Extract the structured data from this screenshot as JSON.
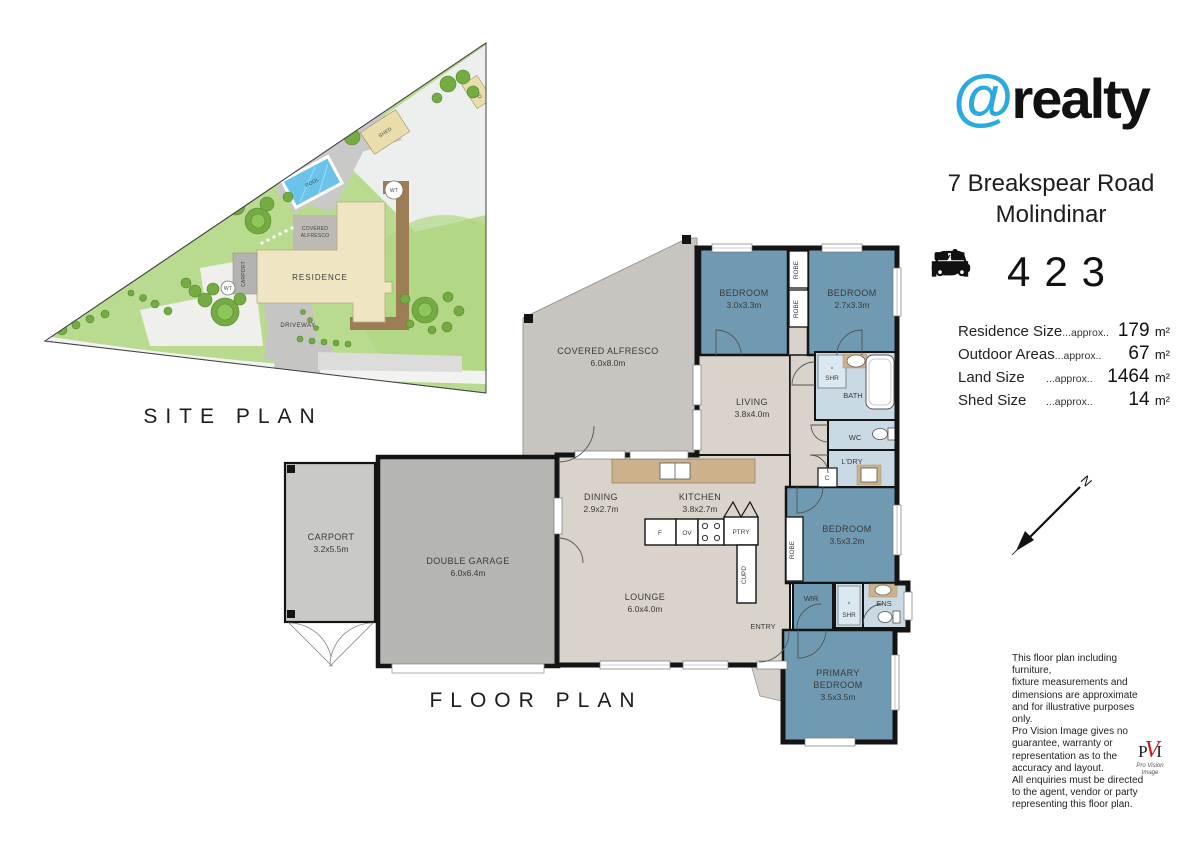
{
  "colors": {
    "brand_blue": "#29aae1",
    "bedroom_fill": "#6f9ab1",
    "wet_area_fill": "#c9dae4",
    "interior_fill": "#d9d3cc",
    "garage_fill": "#b5b6b2",
    "carport_fill": "#c9cac6",
    "alfresco_fill": "#c8c5c1",
    "bench_tan": "#cbb28c",
    "grass_green": "#b9db90",
    "pool_blue": "#6ac4ea",
    "residence_cream": "#efe5c3",
    "deck_brown": "#9d7d55",
    "pvi_red": "#c22026"
  },
  "site_plan": {
    "title": "SITE PLAN",
    "residence": "RESIDENCE",
    "pool": "POOL",
    "shed1": "SHED",
    "shed2": "SHED",
    "driveway": "DRIVEWAY",
    "carport": "CARPORT",
    "alfresco_line1": "COVERED",
    "alfresco_line2": "ALFRESCO",
    "wt1": "WT",
    "wt2": "WT"
  },
  "floor_plan": {
    "title": "FLOOR PLAN",
    "north": "N",
    "rooms": {
      "bedroom1": {
        "name": "BEDROOM",
        "dims": "3.0x3.3m"
      },
      "bedroom2": {
        "name": "BEDROOM",
        "dims": "2.7x3.3m"
      },
      "bedroom3": {
        "name": "BEDROOM",
        "dims": "3.5x3.2m"
      },
      "primary": {
        "name1": "PRIMARY",
        "name2": "BEDROOM",
        "dims": "3.5x3.5m"
      },
      "living": {
        "name": "LIVING",
        "dims": "3.8x4.0m"
      },
      "dining": {
        "name": "DINING",
        "dims": "2.9x2.7m"
      },
      "kitchen": {
        "name": "KITCHEN",
        "dims": "3.8x2.7m"
      },
      "lounge": {
        "name": "LOUNGE",
        "dims": "6.0x4.0m"
      },
      "alfresco": {
        "name": "COVERED ALFRESCO",
        "dims": "6.0x8.0m"
      },
      "garage": {
        "name": "DOUBLE GARAGE",
        "dims": "6.0x6.4m"
      },
      "carport": {
        "name": "CARPORT",
        "dims": "3.2x5.5m"
      }
    },
    "small": {
      "bath": "BATH",
      "shr_main": "SHR",
      "shr_ens": "SHR",
      "wc": "WC",
      "ldry": "L'DRY",
      "cupboard": "C",
      "robe1": "ROBE",
      "robe2": "ROBE",
      "robe3": "ROBE",
      "wir": "WIR",
      "ens": "ENS",
      "entry": "ENTRY",
      "ptry": "PTRY",
      "cupd": "CUPD",
      "fridge": "F",
      "oven": "OV"
    }
  },
  "panel": {
    "brand": {
      "at": "@",
      "name": "realty"
    },
    "address_line1": "7 Breakspear Road",
    "address_line2": "Molindinar",
    "features": {
      "beds": "4",
      "baths": "2",
      "cars": "3"
    },
    "sizes": [
      {
        "label": "Residence Size",
        "approx": "...approx..",
        "value": "179",
        "unit": "m²"
      },
      {
        "label": "Outdoor Areas",
        "approx": "...approx..",
        "value": "67",
        "unit": "m²"
      },
      {
        "label": "Land Size",
        "approx": "...approx..",
        "value": "1464",
        "unit": "m²"
      },
      {
        "label": "Shed Size",
        "approx": "...approx..",
        "value": "14",
        "unit": "m²"
      }
    ],
    "disclaimer": [
      "This floor plan including furniture,",
      "fixture measurements and",
      "dimensions are approximate",
      "and for illustrative purposes only.",
      "Pro Vision Image gives no",
      "guarantee, warranty or",
      "representation as to the",
      "accuracy and layout.",
      "All enquiries must be directed",
      "to the agent, vendor or party",
      "representing this floor plan."
    ],
    "pvi": {
      "p": "P",
      "v": "V",
      "i": "I",
      "sub1": "Pro Vision",
      "sub2": "Image"
    }
  }
}
